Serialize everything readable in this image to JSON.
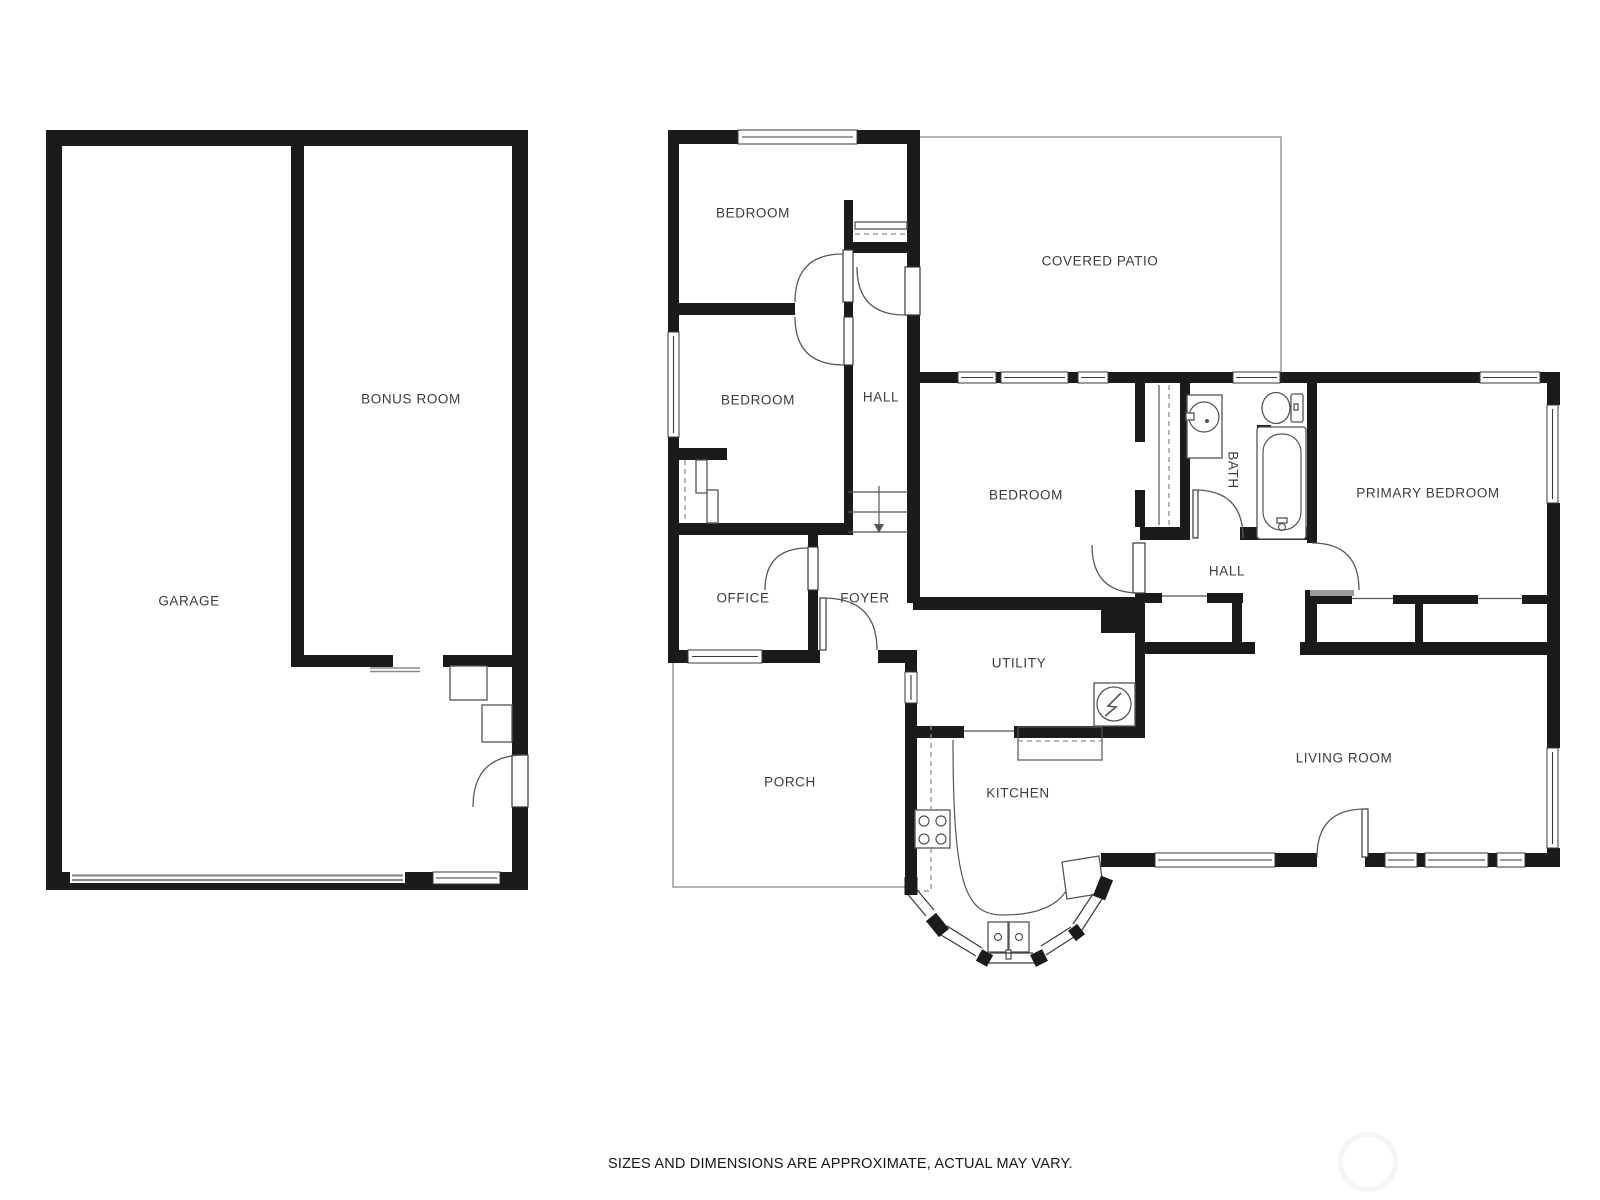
{
  "plan": {
    "type": "floor-plan",
    "background": "#ffffff",
    "colors": {
      "wall": "#1b1b1b",
      "thin_line": "#9a9a9a",
      "label_text": "#3c3c3c"
    },
    "labels": {
      "garage": "GARAGE",
      "bonus_room": "BONUS ROOM",
      "bedroom_top": "BEDROOM",
      "bedroom_mid": "BEDROOM",
      "bedroom_right": "BEDROOM",
      "hall_upper": "HALL",
      "hall_lower": "HALL",
      "covered_patio": "COVERED PATIO",
      "bath": "BATH",
      "primary_bedroom": "PRIMARY BEDROOM",
      "office": "OFFICE",
      "foyer": "FOYER",
      "utility": "UTILITY",
      "kitchen": "KITCHEN",
      "living_room": "LIVING ROOM",
      "porch": "PORCH"
    },
    "disclaimer": "SIZES AND DIMENSIONS ARE APPROXIMATE, ACTUAL MAY VARY."
  }
}
